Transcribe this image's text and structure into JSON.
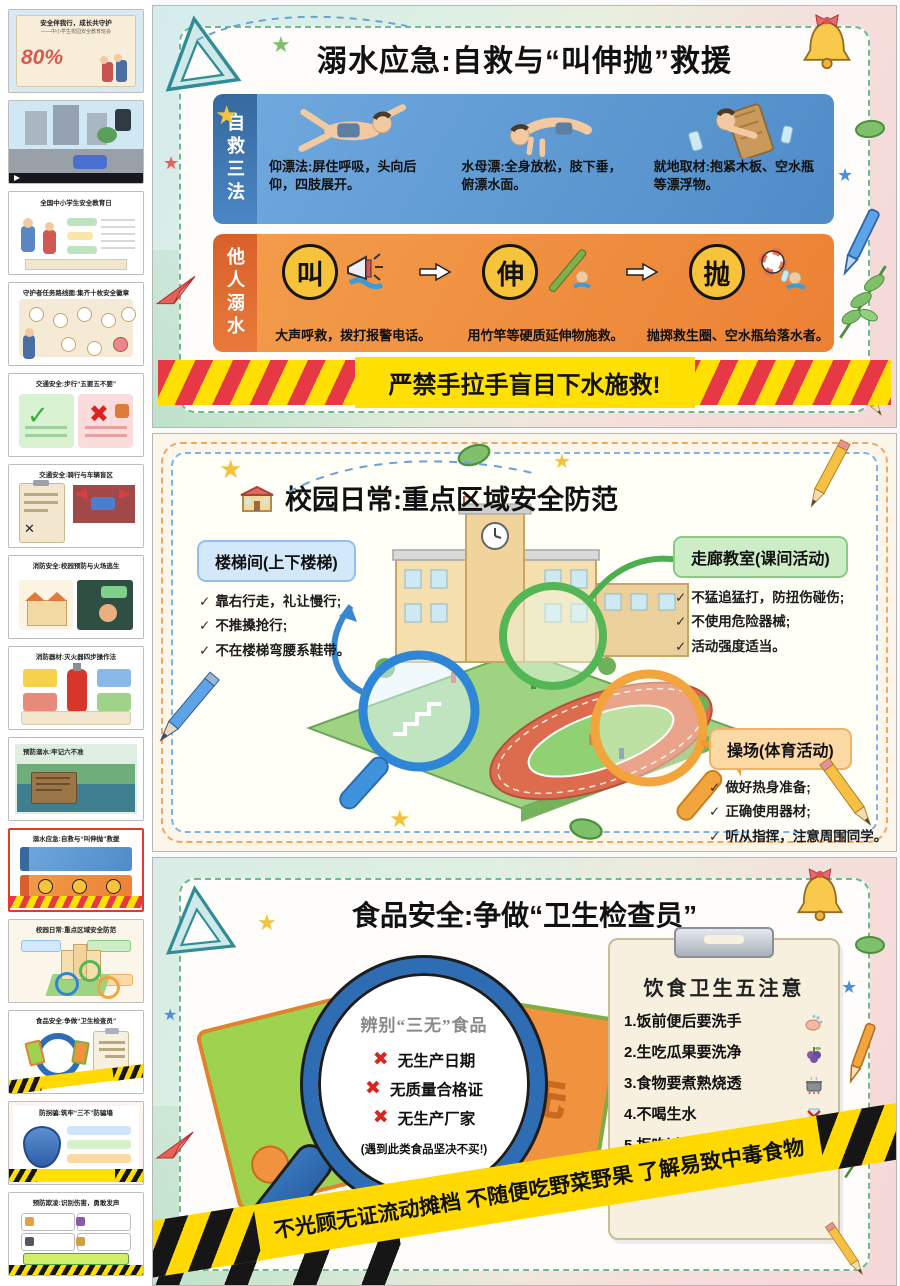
{
  "glyphs": {
    "check": "✓",
    "cross": "✖",
    "star": "★"
  },
  "colors": {
    "selected_thumb_border": "#e23b2e",
    "panel_dash_green": "#6cba8e",
    "blue_section": "#4f8cc8",
    "blue_strip": "#35699f",
    "orange_section": "#ec8134",
    "orange_strip": "#d95f2b",
    "step_circle_yellow": "#f7c33b",
    "warning_yellow": "#ffe000",
    "warning_red": "#e73845",
    "banner_yellow": "#ffd900",
    "banner_black": "#161616",
    "zone_blue": "#d3e9fb",
    "zone_green": "#cdedc6",
    "zone_orange": "#fcd9a4",
    "magnifier_blue": "#2e6db4"
  },
  "sidebar": {
    "thumbnails": [
      {
        "kind": "cover",
        "title": "安全伴我行，成长共守护",
        "subtitle": "——中小学生校园安全教育班会",
        "badge": "80%",
        "selected": false
      },
      {
        "kind": "video",
        "title": "",
        "selected": false
      },
      {
        "kind": "docday",
        "title": "全国中小学生安全教育日",
        "selected": false
      },
      {
        "kind": "badges",
        "title": "守护者任务路线图:集齐十枚安全徽章",
        "selected": false
      },
      {
        "kind": "walk",
        "title": "交通安全:步行“五要五不要”",
        "selected": false
      },
      {
        "kind": "ride",
        "title": "交通安全:骑行与车辆盲区",
        "selected": false
      },
      {
        "kind": "fire",
        "title": "消防安全:校园预防与火场逃生",
        "selected": false
      },
      {
        "kind": "extinguisher",
        "title": "消防器材:灭火器四步操作法",
        "selected": false
      },
      {
        "kind": "water",
        "title": "预防溺水:牢记六不准",
        "selected": false
      },
      {
        "kind": "drown",
        "title": "溺水应急:自救与“叫伸抛”救援",
        "selected": true
      },
      {
        "kind": "campus",
        "title": "校园日常:重点区域安全防范",
        "selected": false
      },
      {
        "kind": "food",
        "title": "食品安全:争做“卫生检查员”",
        "selected": false
      },
      {
        "kind": "scam",
        "title": "防拐骗:筑牢“三不”防骗墙",
        "selected": false
      },
      {
        "kind": "bully",
        "title": "预防欺凌:识别伤害，勇敢发声",
        "selected": false
      }
    ]
  },
  "slides": {
    "drowning": {
      "title": "溺水应急:自救与“叫伸抛”救援",
      "self_rescue": {
        "label": "自救三法",
        "captions": [
          "仰漂法:屏住呼吸，头向后仰，四肢展开。",
          "水母漂:全身放松，肢下垂，俯漂水面。",
          "就地取材:抱紧木板、空水瓶等漂浮物。"
        ]
      },
      "others": {
        "label": "他人溺水",
        "steps": [
          {
            "char": "叫",
            "caption": "大声呼救，拨打报警电话。"
          },
          {
            "char": "伸",
            "caption": "用竹竿等硬质延伸物施救。"
          },
          {
            "char": "抛",
            "caption": "抛掷救生圈、空水瓶给落水者。"
          }
        ]
      },
      "warning": "严禁手拉手盲目下水施救!"
    },
    "campus": {
      "title": "校园日常:重点区域安全防范",
      "zones": [
        {
          "label": "楼梯间(上下楼梯)",
          "tips": [
            "靠右行走，礼让慢行;",
            "不推搡抢行;",
            "不在楼梯弯腰系鞋带。"
          ]
        },
        {
          "label": "走廊教室(课间活动)",
          "tips": [
            "不猛追猛打，防扭伤碰伤;",
            "不使用危险器械;",
            "活动强度适当。"
          ]
        },
        {
          "label": "操场(体育活动)",
          "tips": [
            "做好热身准备;",
            "正确使用器材;",
            "听从指挥，注意周围同学。"
          ]
        }
      ]
    },
    "food": {
      "title": "食品安全:争做“卫生检查员”",
      "bag_char": "无",
      "magnifier": {
        "heading": "辨别“三无”食品",
        "items": [
          "无生产日期",
          "无质量合格证",
          "无生产厂家"
        ],
        "note": "(遇到此类食品坚决不买!)"
      },
      "clipboard": {
        "heading": "饮食卫生五注意",
        "items": [
          "1.饭前便后要洗手",
          "2.生吃瓜果要洗净",
          "3.食物要煮熟烧透",
          "4.不喝生水",
          "5.拒吃过期与“三无”食品"
        ]
      },
      "banner": "不光顾无证流动摊档  不随便吃野菜野果  了解易致中毒食物"
    }
  }
}
